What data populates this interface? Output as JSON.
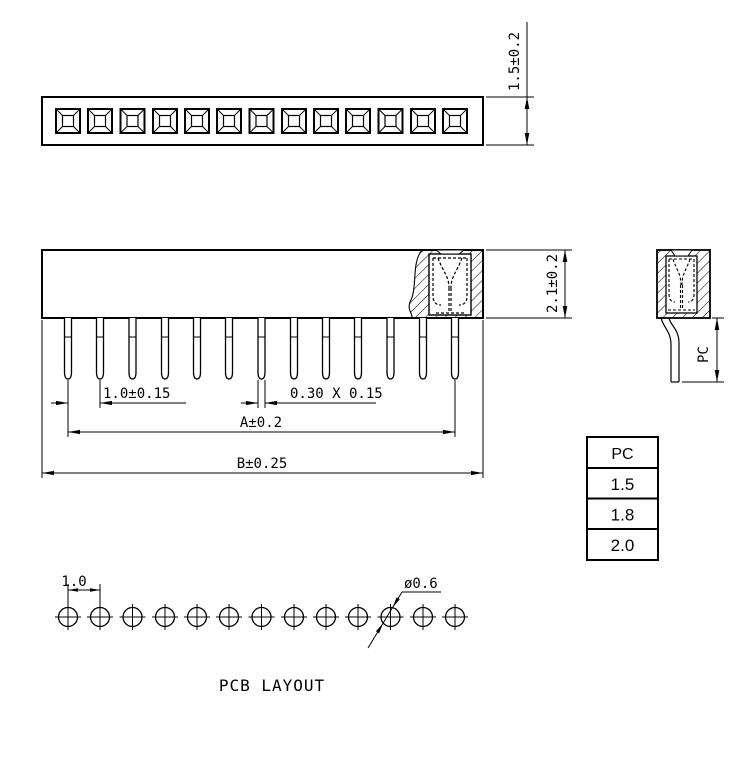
{
  "colors": {
    "ink": "#000000",
    "paper": "#ffffff"
  },
  "positions": 13,
  "dims": {
    "insulator_height": "1.5±0.2",
    "body_height": "2.1±0.2",
    "pin_pitch": "1.0±0.15",
    "pin_cross_section": "0.30 X 0.15",
    "span_a": "A±0.2",
    "span_b": "B±0.25",
    "pin_length": "PC"
  },
  "pc_table": {
    "header": "PC",
    "rows": [
      "1.5",
      "1.8",
      "2.0"
    ]
  },
  "pcb": {
    "caption": "PCB LAYOUT",
    "hole_pitch": "1.0",
    "hole_diameter": "ø0.6"
  }
}
